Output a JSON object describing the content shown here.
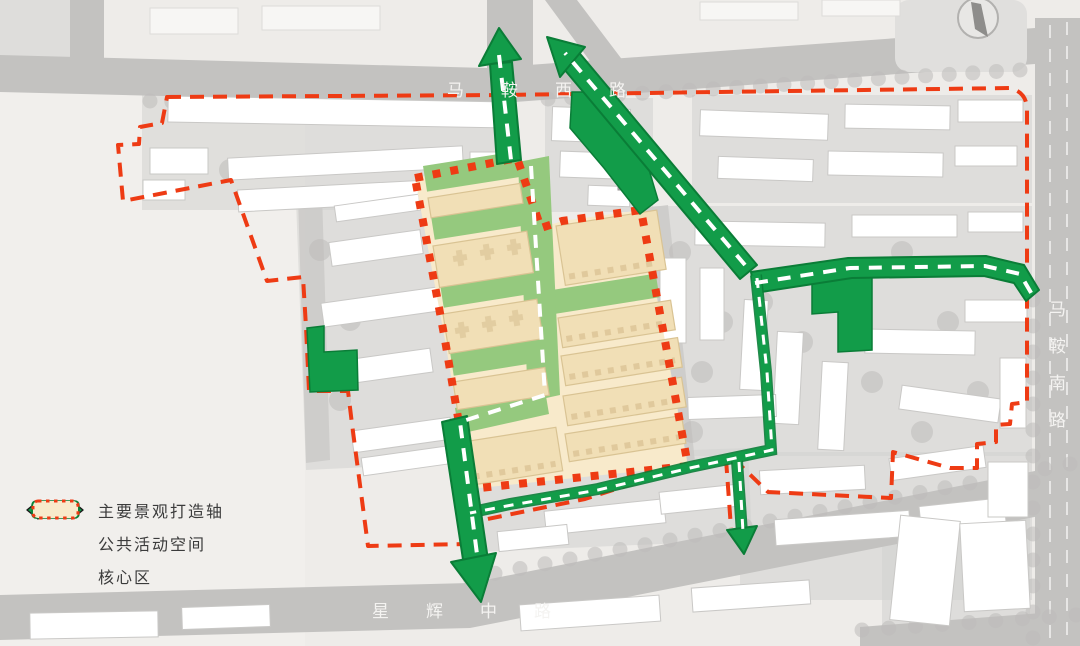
{
  "map": {
    "road_labels": {
      "top": "马鞍西路",
      "right": "马鞍南路",
      "bottom": "星辉中路"
    }
  },
  "legend": {
    "items": [
      {
        "icon": "axis-arrow-icon",
        "label": "主要景观打造轴"
      },
      {
        "icon": "public-space-icon",
        "label": "公共活动空间"
      },
      {
        "icon": "core-area-icon",
        "label": "核心区"
      }
    ]
  },
  "colors": {
    "green": "#129c49",
    "green_dark": "#0a7d37",
    "lgreen": "#95c97e",
    "tan": "#f8eacb",
    "red": "#ee3b14",
    "road": "#c3c2c0",
    "bg": "#eeece9",
    "label": "#f4f3f1",
    "text": "#3b3b3b"
  }
}
